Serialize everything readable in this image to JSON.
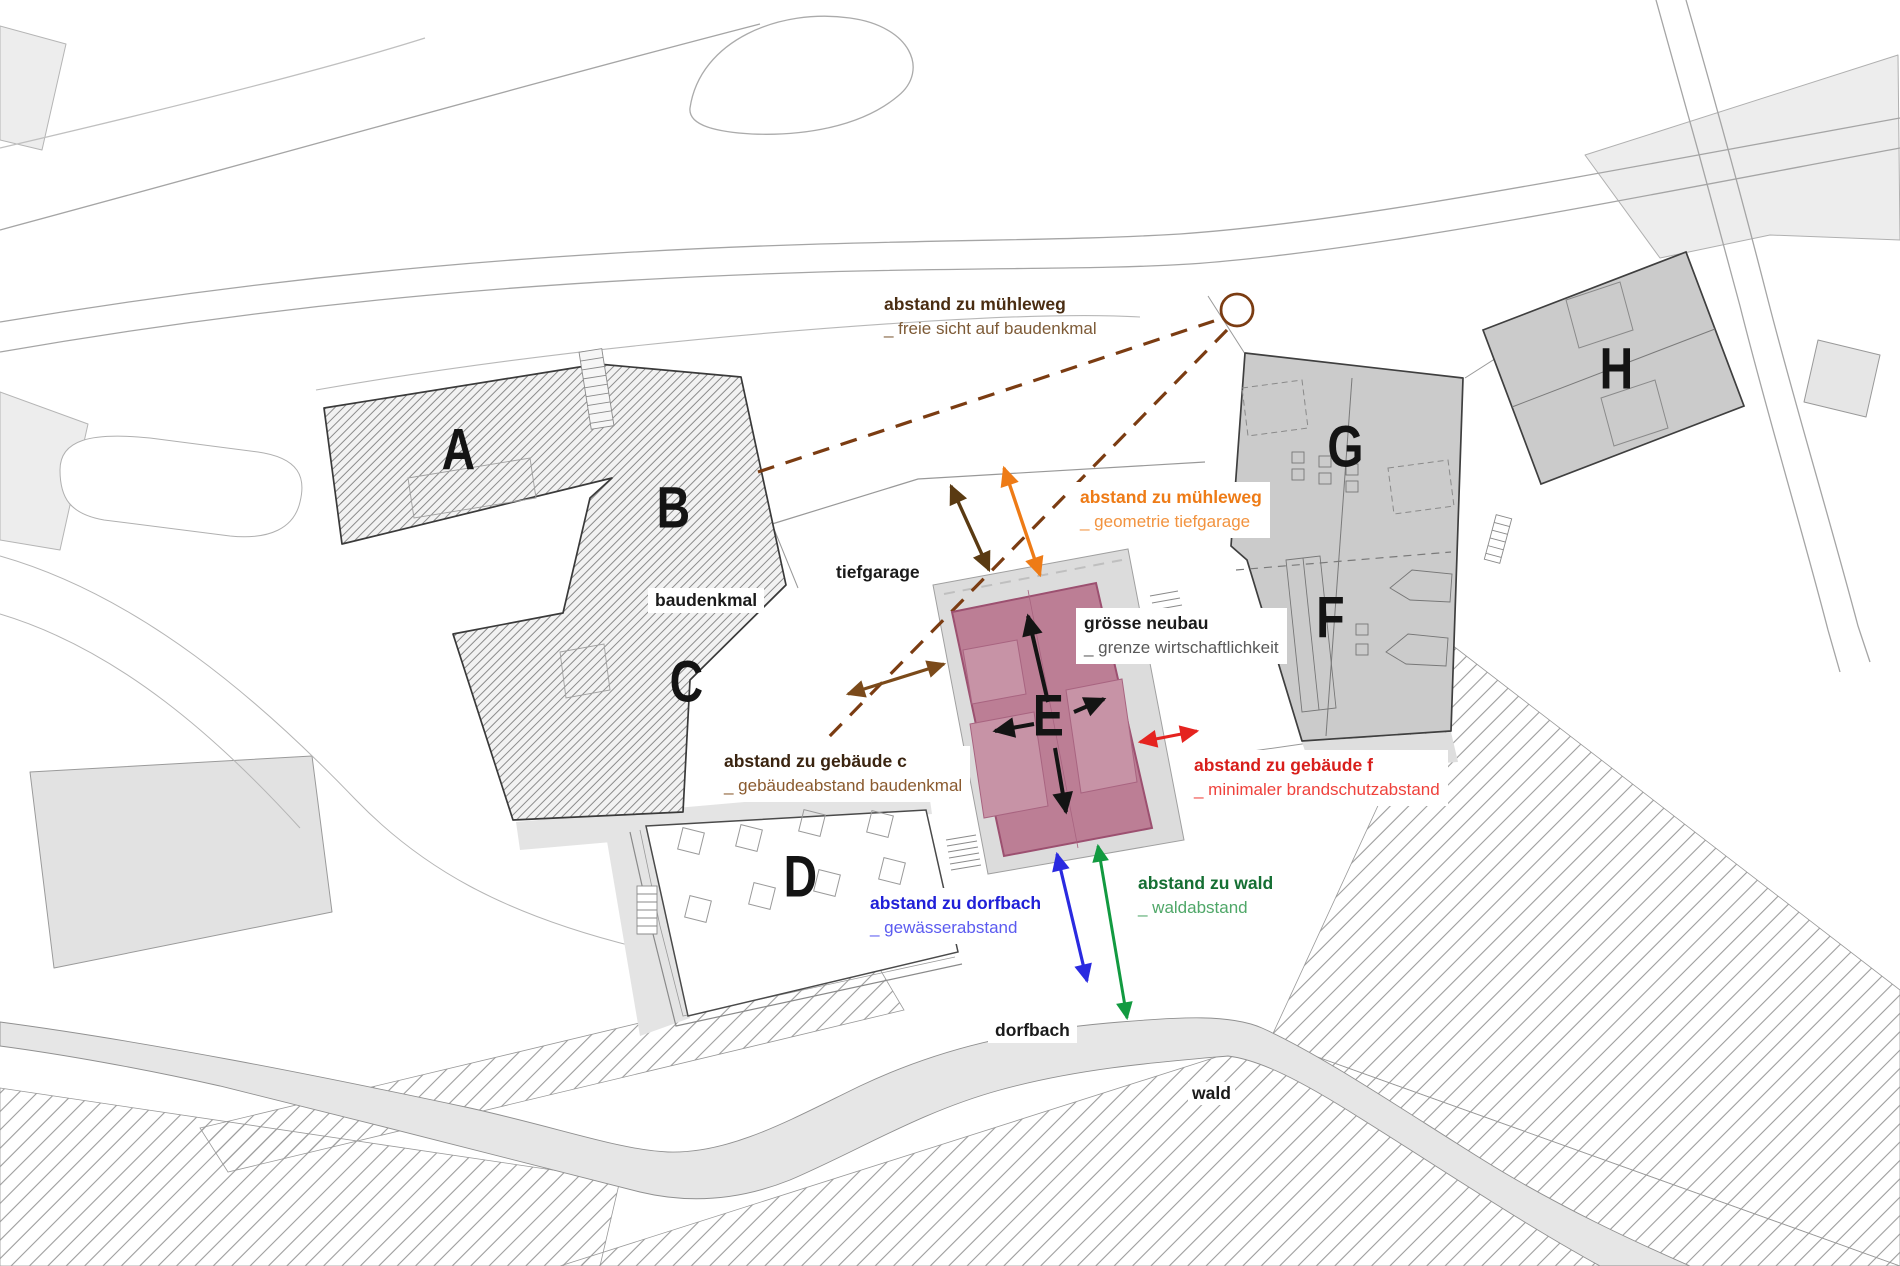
{
  "buildings": [
    {
      "label": "A"
    },
    {
      "label": "B"
    },
    {
      "label": "C"
    },
    {
      "label": "D"
    },
    {
      "label": "E"
    },
    {
      "label": "F"
    },
    {
      "label": "G"
    },
    {
      "label": "H"
    }
  ],
  "area_labels": {
    "baudenkmal": "baudenkmal",
    "tiefgarage": "tiefgarage",
    "dorfbach": "dorfbach",
    "wald": "wald"
  },
  "annotations": [
    {
      "id": "muehleweg-sicht",
      "title": "abstand zu mühleweg",
      "subtitle": "_ freie sicht auf baudenkmal",
      "title_color": "#4a2d12",
      "subtitle_color": "#7d5a36"
    },
    {
      "id": "muehleweg-tiefgarage",
      "title": "abstand zu mühleweg",
      "subtitle": "_ geometrie tiefgarage",
      "title_color": "#ee7b16",
      "subtitle_color": "#f2933f"
    },
    {
      "id": "groesse-neubau",
      "title": "grösse neubau",
      "subtitle": "_ grenze wirtschaftlichkeit",
      "title_color": "#1a1a1a",
      "subtitle_color": "#5a5a5a"
    },
    {
      "id": "abstand-gebaeude-c",
      "title": "abstand zu gebäude c",
      "subtitle": "_ gebäudeabstand baudenkmal",
      "title_color": "#3a2410",
      "subtitle_color": "#8a5a2e"
    },
    {
      "id": "abstand-gebaeude-f",
      "title": "abstand zu gebäude f",
      "subtitle": "_ minimaler brandschutzabstand",
      "title_color": "#d81f1b",
      "subtitle_color": "#ef423c"
    },
    {
      "id": "abstand-dorfbach",
      "title": "abstand zu dorfbach",
      "subtitle": "_ gewässerabstand",
      "title_color": "#2020d8",
      "subtitle_color": "#5b5bf0"
    },
    {
      "id": "abstand-wald",
      "title": "abstand zu wald",
      "subtitle": "_ waldabstand",
      "title_color": "#156f33",
      "subtitle_color": "#4fa768"
    }
  ],
  "colors": {
    "neubau_fill": "#bc7e95",
    "neubau_border": "#9c5070",
    "bestand_fill": "#cbcbcb",
    "sight_dash_brown": "#7b3c12",
    "arrow_brown_dark": "#5a3a12",
    "arrow_brown": "#7b4a1a",
    "arrow_orange": "#ee7b16",
    "arrow_red": "#e5231f",
    "arrow_blue": "#2a2ae0",
    "arrow_green": "#129a40",
    "arrow_black": "#141414"
  }
}
